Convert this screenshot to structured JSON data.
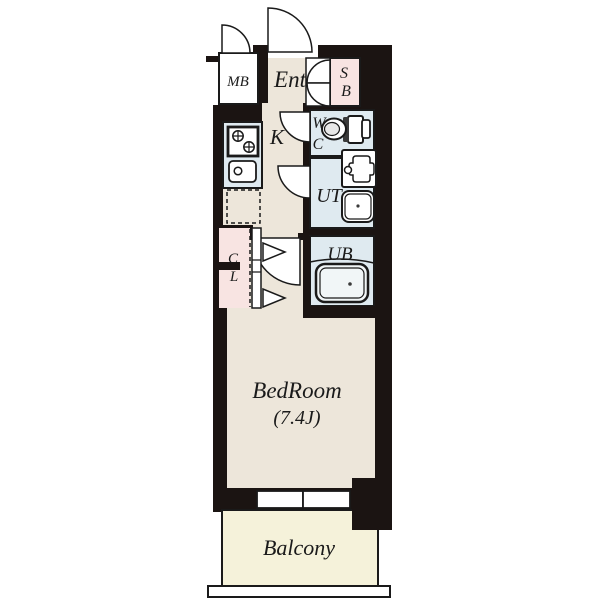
{
  "plan": {
    "labels": {
      "mb": "MB",
      "ent": "Ent",
      "sb_s": "S",
      "sb_b": "B",
      "wc_w": "W",
      "wc_c": "C",
      "k": "K",
      "ut": "UT",
      "cl_c": "C",
      "cl_l": "L",
      "ub": "UB",
      "bedroom": "BedRoom",
      "bedroom_size": "(7.4J)",
      "balcony": "Balcony"
    }
  },
  "colors": {
    "wall": "#1b1412",
    "floor": "#ede6da",
    "wet": "#dfeaf0",
    "storage": "#f8e4e2",
    "balcony": "#f5f2da",
    "outline": "#1a1a1a",
    "white": "#ffffff"
  }
}
